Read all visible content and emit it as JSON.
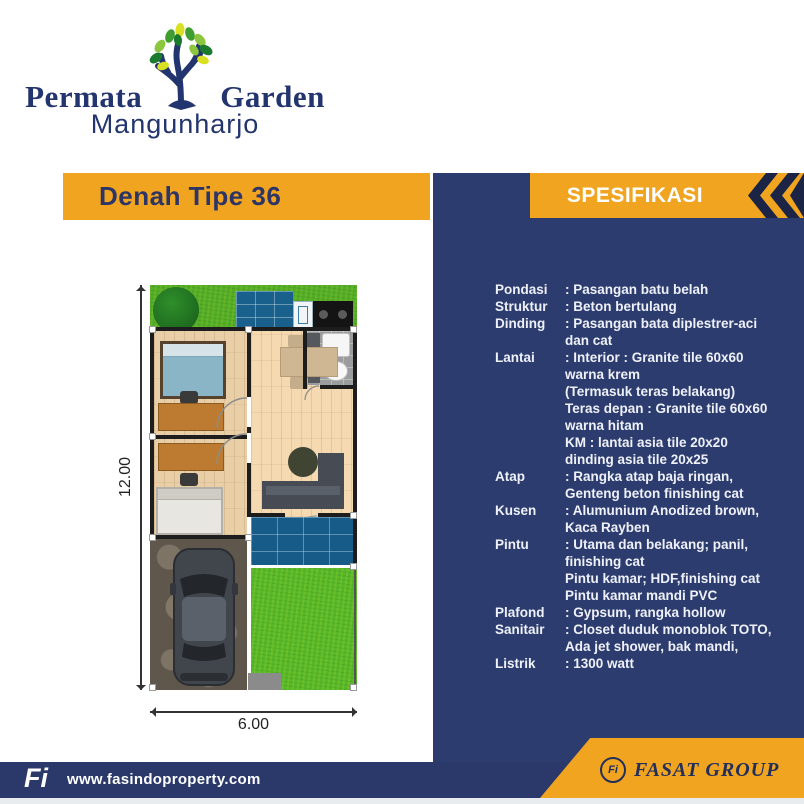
{
  "logo": {
    "brand_left": "Permata",
    "brand_right": "Garden",
    "brand_sub": "Mangunharjo",
    "tree_icon": "tree-icon"
  },
  "left_section": {
    "title": "Denah Tipe 36"
  },
  "right_section": {
    "title": "SPESIFIKASI",
    "chevron_icon": "double-chevron-left-icon"
  },
  "specs": [
    {
      "label": "Pondasi",
      "lines": [
        ": Pasangan batu belah"
      ]
    },
    {
      "label": "Struktur",
      "lines": [
        ": Beton bertulang"
      ]
    },
    {
      "label": "Dinding",
      "lines": [
        ": Pasangan bata diplestrer-aci",
        "dan cat"
      ]
    },
    {
      "label": "Lantai",
      "lines": [
        ": Interior : Granite tile 60x60",
        "warna krem",
        "(Termasuk teras belakang)",
        "Teras depan : Granite tile 60x60",
        "warna hitam",
        "KM : lantai asia tile 20x20",
        "dinding asia tile 20x25"
      ]
    },
    {
      "label": "Atap",
      "lines": [
        ": Rangka atap baja ringan,",
        "Genteng beton finishing cat"
      ]
    },
    {
      "label": "Kusen",
      "lines": [
        ": Alumunium Anodized brown,",
        "Kaca Rayben"
      ]
    },
    {
      "label": "Pintu",
      "lines": [
        ": Utama dan belakang; panil,",
        "finishing cat",
        "Pintu kamar; HDF,finishing cat",
        "Pintu kamar mandi PVC"
      ]
    },
    {
      "label": "Plafond",
      "lines": [
        ": Gypsum, rangka hollow"
      ]
    },
    {
      "label": "Sanitair",
      "lines": [
        ": Closet duduk monoblok TOTO,",
        "Ada jet shower, bak mandi,"
      ]
    },
    {
      "label": "Listrik",
      "lines": [
        ": 1300 watt"
      ]
    }
  ],
  "floor_plan": {
    "height_label": "12.00",
    "width_label": "6.00"
  },
  "footer": {
    "site_logo": "Fi",
    "website": "www.fasindoproperty.com",
    "group_logo": "Fi",
    "group_name": "FASAT GROUP"
  },
  "colors": {
    "orange": "#F1A41F",
    "panel_navy": "#2D3C6F",
    "bar_navy": "#2A3969",
    "dark_navy": "#1B2444",
    "title_navy": "#2C3566",
    "logo_navy": "#23356E",
    "spec_text": "#EEF1F8"
  }
}
